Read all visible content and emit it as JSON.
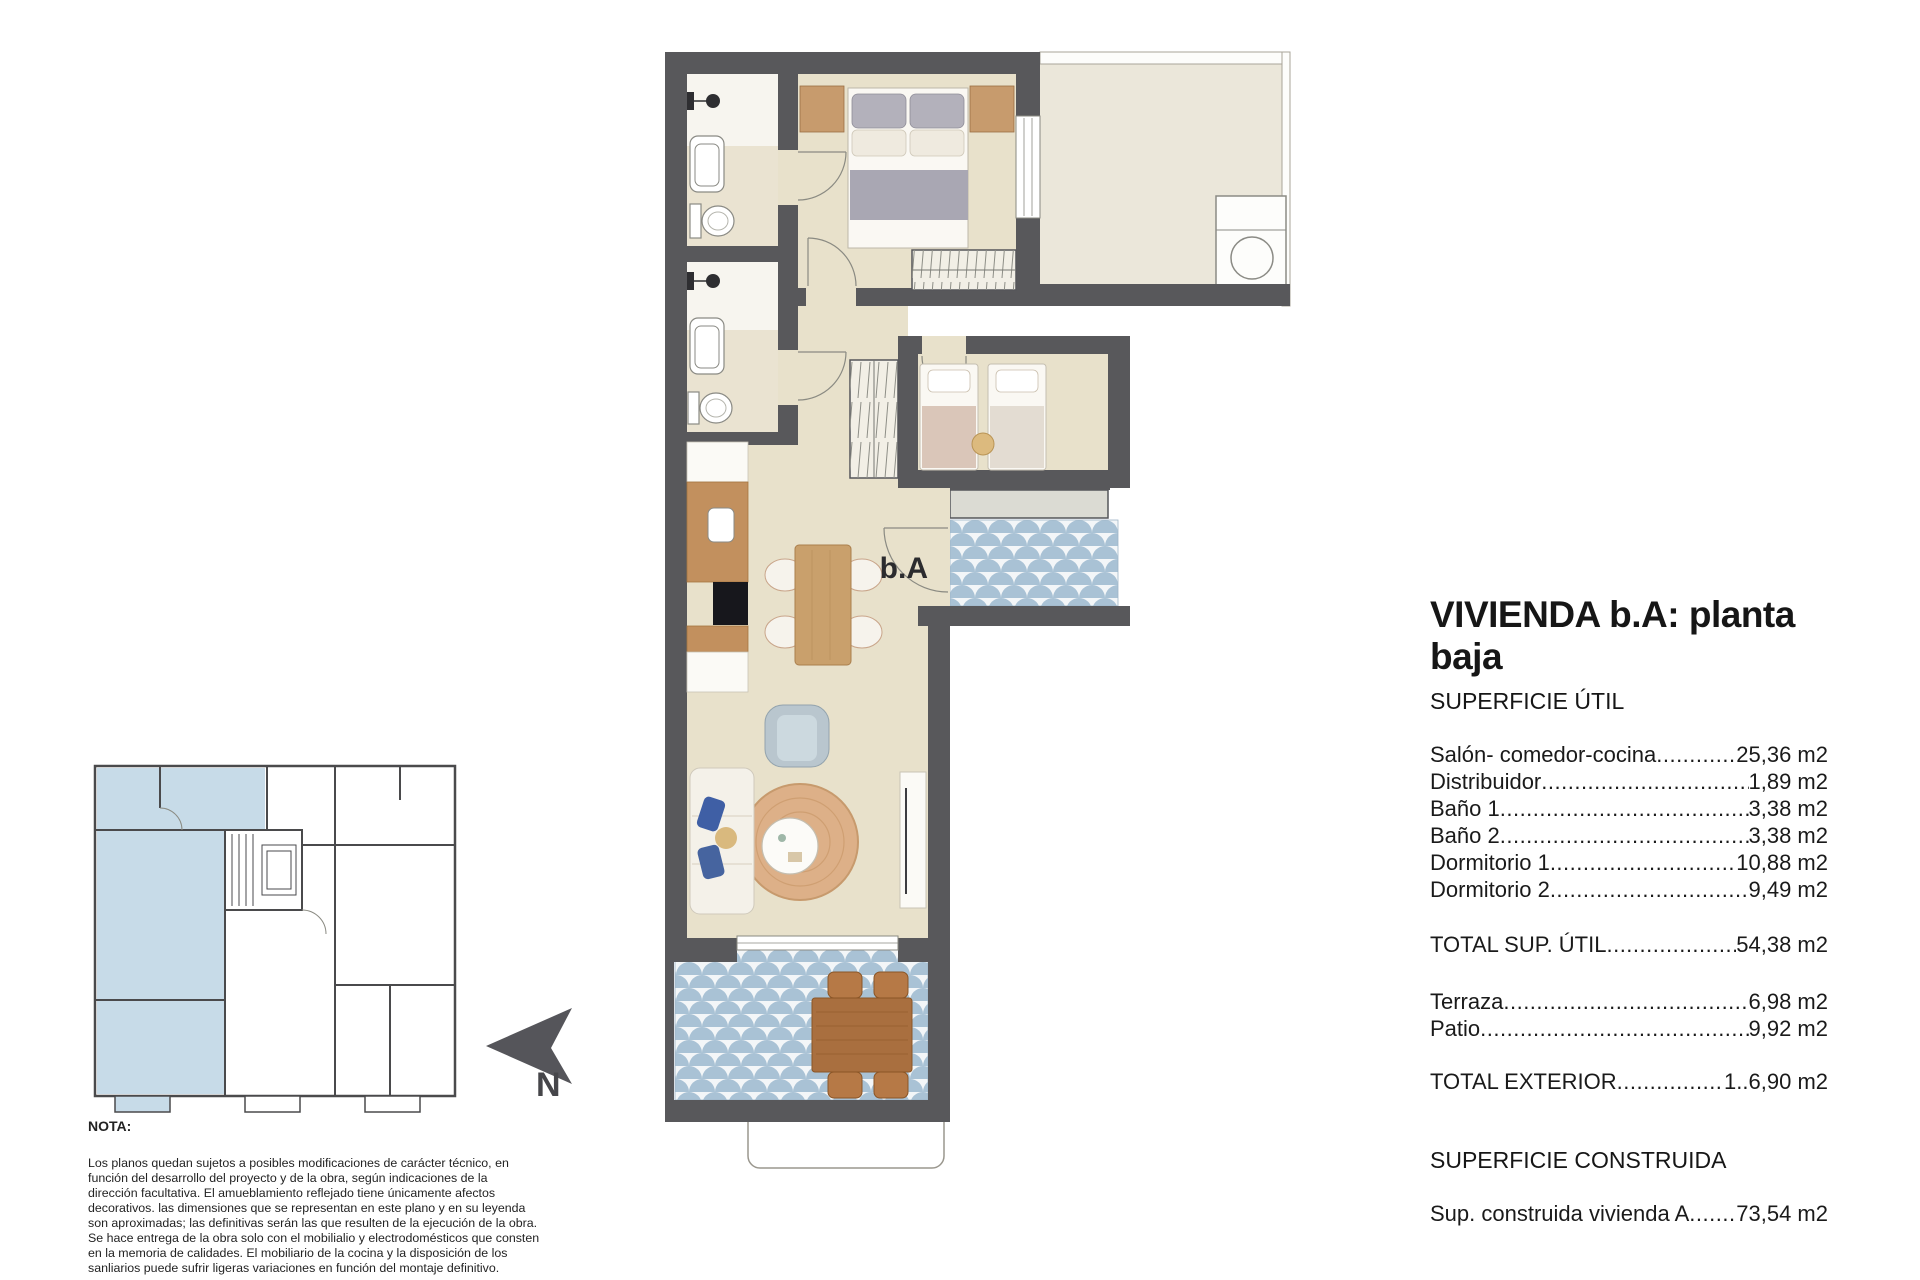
{
  "title_block": {
    "title": "VIVIENDA b.A: planta baja",
    "superficie_util_heading": "SUPERFICIE ÚTIL",
    "util_rows": [
      {
        "label": "Salón- comedor-cocina",
        "value": "25,36 m2"
      },
      {
        "label": "Distribuidor",
        "value": "1,89 m2"
      },
      {
        "label": "Baño 1",
        "value": "3,38 m2"
      },
      {
        "label": "Baño 2",
        "value": "3,38 m2"
      },
      {
        "label": "Dormitorio 1",
        "value": "10,88 m2"
      },
      {
        "label": "Dormitorio 2",
        "value": "9,49 m2"
      }
    ],
    "total_util": {
      "label": "TOTAL SUP. ÚTIL",
      "value": "54,38 m2"
    },
    "exterior_rows": [
      {
        "label": "Terraza",
        "value": "6,98 m2"
      },
      {
        "label": "Patio",
        "value": "9,92 m2"
      }
    ],
    "total_exterior": {
      "label": "TOTAL EXTERIOR",
      "value": "1..6,90 m2"
    },
    "superficie_construida_heading": "SUPERFICIE CONSTRUIDA",
    "construida_row": {
      "label": "Sup. construida vivienda A",
      "value": "73,54 m2"
    }
  },
  "plan": {
    "entrance_label": "b.A"
  },
  "key_plan": {
    "north_label": "N"
  },
  "note": {
    "heading": "NOTA:",
    "body": "Los planos quedan sujetos a posibles modificaciones de carácter técnico, en función del desarrollo del proyecto y de la obra, según indicaciones de la dirección facultativa. El amueblamiento reflejado tiene únicamente afectos decorativos. las dimensiones que se representan en este plano y en su leyenda son aproximadas; las definitivas serán las que resulten de la ejecución de la obra. Se hace entrega de la obra solo con el mobilialio y electrodomésticos que consten en la memoria de calidades. El mobiliario de la cocina y la disposición de los sanliarios puede sufrir ligeras variaciones en función del montaje definitivo."
  },
  "dots": "........................................................................................................................................................................................",
  "colors": {
    "wall": "#58585b",
    "floor": "#e8e1cb",
    "bath_floor": "#eae3d1",
    "patio_floor": "#ebe7da",
    "tile_blue": "#a9c2d5",
    "tile_bg": "#f3f6f8",
    "gray_step": "#dbdbd3",
    "wood": "#c79b6d",
    "keyplan_highlight": "#c7dbe8"
  }
}
